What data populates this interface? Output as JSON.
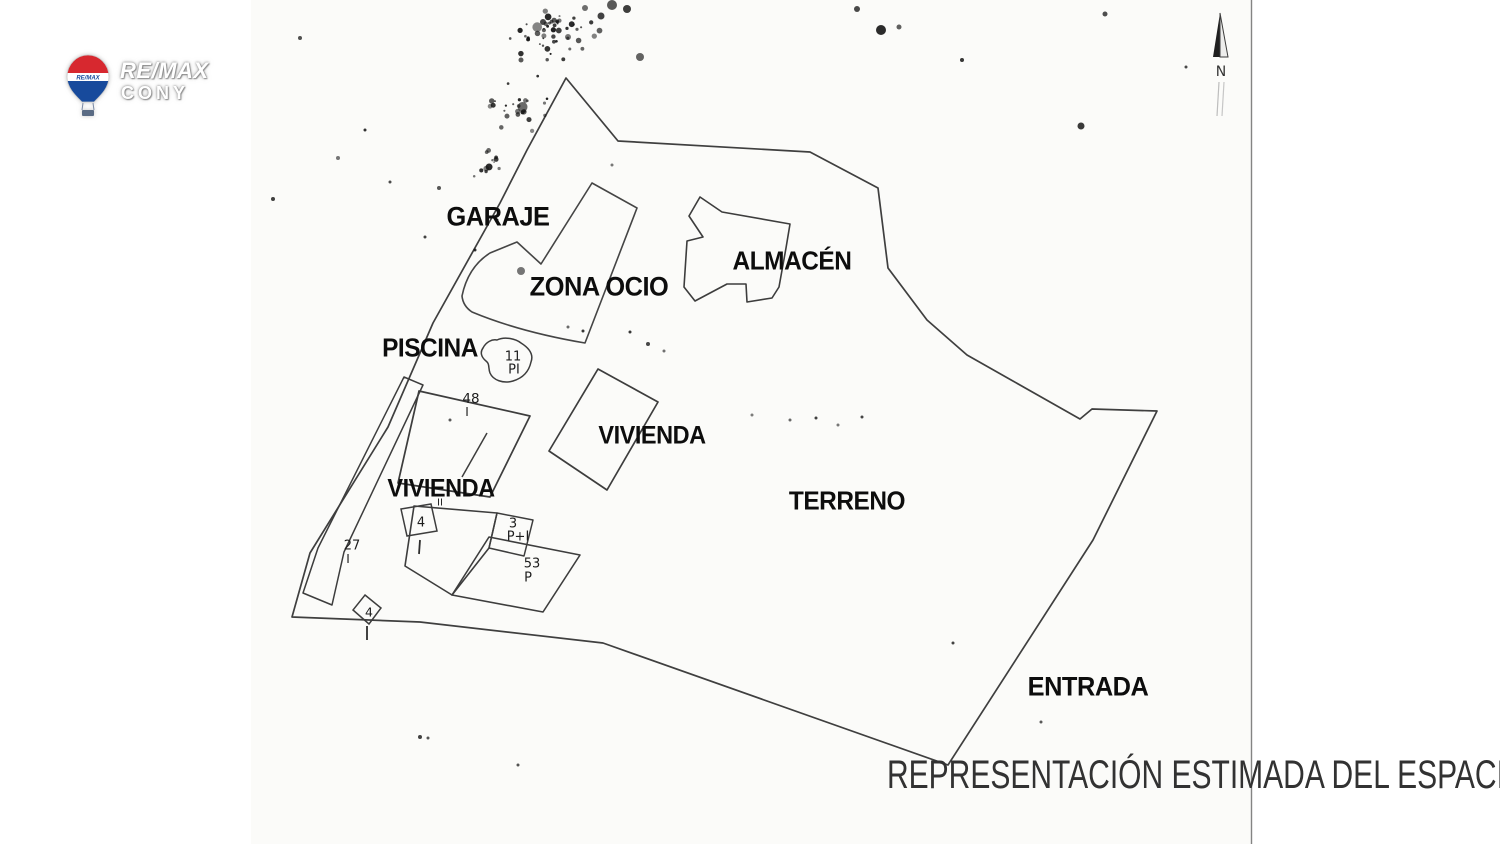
{
  "page": {
    "caption": "REPRESENTACIÓN ESTIMADA DEL ESPACIO"
  },
  "logo": {
    "brand": "RE/MAX",
    "office": "CONY",
    "balloon_text": "RE/MAX",
    "balloon_red": "#d7282f",
    "balloon_blue": "#174a9c"
  },
  "compass": {
    "label": "N"
  },
  "plan": {
    "area_labels": [
      {
        "id": "garaje",
        "text": "GARAJE",
        "x": 498,
        "y": 217,
        "size": 27
      },
      {
        "id": "zona-ocio",
        "text": "ZONA OCIO",
        "x": 599,
        "y": 287,
        "size": 27
      },
      {
        "id": "almacen",
        "text": "ALMACÉN",
        "x": 792,
        "y": 261,
        "size": 26
      },
      {
        "id": "piscina",
        "text": "PISCINA",
        "x": 430,
        "y": 348,
        "size": 26
      },
      {
        "id": "vivienda-right",
        "text": "VIVIENDA",
        "x": 652,
        "y": 436,
        "size": 25
      },
      {
        "id": "vivienda-left",
        "text": "VIVIENDA",
        "x": 441,
        "y": 489,
        "size": 25
      },
      {
        "id": "terreno",
        "text": "TERRENO",
        "x": 847,
        "y": 501,
        "size": 26
      },
      {
        "id": "entrada",
        "text": "ENTRADA",
        "x": 1088,
        "y": 687,
        "size": 27
      }
    ],
    "annotations": [
      {
        "id": "pool-floors",
        "text": "11",
        "x": 513,
        "y": 357,
        "size": 13
      },
      {
        "id": "pool-code",
        "text": "PI",
        "x": 514,
        "y": 370,
        "size": 13
      },
      {
        "id": "bldg48-number",
        "text": "48",
        "x": 471,
        "y": 399,
        "size": 13.5
      },
      {
        "id": "bldg48-floors",
        "text": "I",
        "x": 467,
        "y": 412,
        "size": 12
      },
      {
        "id": "sq4a-number",
        "text": "4",
        "x": 421,
        "y": 523,
        "size": 13
      },
      {
        "id": "strip-number",
        "text": "27",
        "x": 352,
        "y": 546,
        "size": 13
      },
      {
        "id": "strip-floors",
        "text": "I",
        "x": 348,
        "y": 559,
        "size": 12
      },
      {
        "id": "b3-number",
        "text": "3",
        "x": 513,
        "y": 524,
        "size": 13
      },
      {
        "id": "b3-floors",
        "text": "P+I",
        "x": 518,
        "y": 537,
        "size": 13
      },
      {
        "id": "b53-number",
        "text": "53",
        "x": 532,
        "y": 564,
        "size": 13
      },
      {
        "id": "b53-floors",
        "text": "P",
        "x": 528,
        "y": 578,
        "size": 13
      },
      {
        "id": "sq4b-number",
        "text": "4",
        "x": 369,
        "y": 612,
        "size": 12.5
      },
      {
        "id": "vivienda-left-floors",
        "text": "II",
        "x": 440,
        "y": 503,
        "size": 10
      }
    ]
  }
}
